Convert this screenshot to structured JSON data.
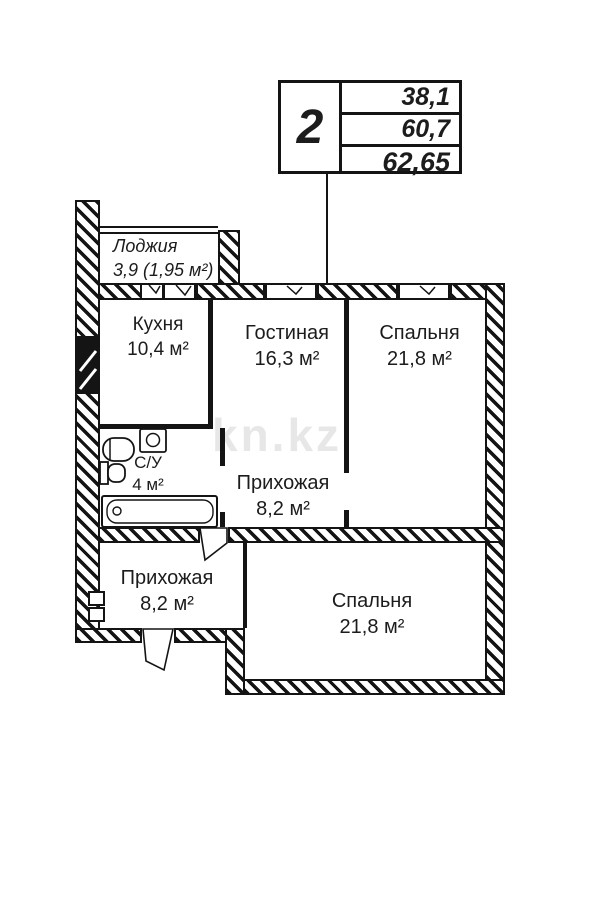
{
  "title_block": {
    "rooms_count": "2",
    "rows": [
      {
        "label": "living-area",
        "value": "38,1"
      },
      {
        "label": "total-area",
        "value": "60,7"
      },
      {
        "label": "full-area-with-loggia",
        "value": "62,65"
      }
    ]
  },
  "rooms": {
    "loggia": {
      "name": "Лоджия",
      "area": "3,9 (1,95 м²)"
    },
    "kitchen": {
      "name": "Кухня",
      "area": "10,4 м²"
    },
    "living": {
      "name": "Гостиная",
      "area": "16,3 м²"
    },
    "bedroom1": {
      "name": "Спальня",
      "area": "21,8 м²"
    },
    "bathroom": {
      "name": "С/У",
      "area": "4 м²"
    },
    "hallway1": {
      "name": "Прихожая",
      "area": "8,2 м²"
    },
    "hallway2": {
      "name": "Прихожая",
      "area": "8,2 м²"
    },
    "bedroom2": {
      "name": "Спальня",
      "area": "21,8 м²"
    }
  },
  "watermark": "kn.kz",
  "colors": {
    "ink": "#141414",
    "watermark": "#d4d4d4"
  }
}
